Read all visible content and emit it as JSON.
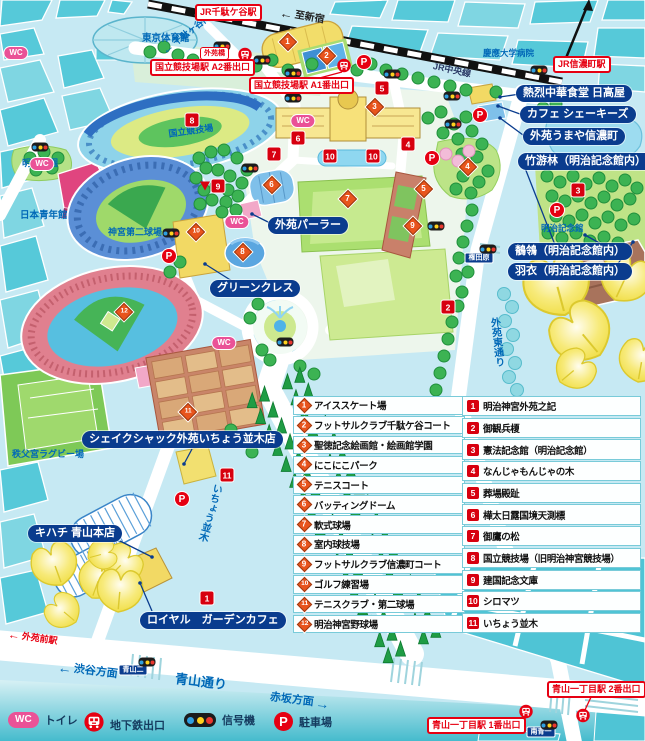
{
  "colors": {
    "navy": "#0a3c8e",
    "red": "#e60012",
    "marker_red": "#d7000f",
    "orange": "#e8541d",
    "pink": "#ea5297",
    "blue_text": "#0068b7",
    "signal_blue": "#2f9fe0",
    "signal_yellow": "#ffd21e",
    "signal_red": "#e8382f"
  },
  "map": {
    "wc_label": "WC",
    "parking_label": "P",
    "station_labels": [
      {
        "text": "JR千駄ケ谷駅",
        "x": 195,
        "y": 4
      },
      {
        "text": "国立競技場駅 A2番出口",
        "x": 150,
        "y": 59
      },
      {
        "text": "国立競技場駅 A1番出口",
        "x": 249,
        "y": 77
      },
      {
        "text": "JR信濃町駅",
        "x": 553,
        "y": 56
      },
      {
        "text": "青山一丁目駅 2番出口",
        "x": 547,
        "y": 681
      },
      {
        "text": "青山一丁目駅 1番出口",
        "x": 427,
        "y": 717
      }
    ],
    "small_red_labels": [
      {
        "text": "外苑橋",
        "x": 200,
        "y": 47
      }
    ],
    "pill_labels": [
      {
        "text": "熱烈中華食堂 日高屋",
        "x": 516,
        "y": 85
      },
      {
        "text": "カフェ シェーキーズ",
        "x": 520,
        "y": 106
      },
      {
        "text": "外苑うまや信濃町",
        "x": 523,
        "y": 128
      },
      {
        "text": "竹游林（明治記念館内）",
        "x": 518,
        "y": 153
      },
      {
        "text": "鶺鴒（明治記念館内）",
        "x": 508,
        "y": 243
      },
      {
        "text": "羽衣（明治記念館内）",
        "x": 508,
        "y": 263
      },
      {
        "text": "外苑パーラー",
        "x": 268,
        "y": 217
      },
      {
        "text": "グリーンクレス",
        "x": 210,
        "y": 280
      },
      {
        "text": "シェイクシャック外苑いちょう並木店",
        "x": 82,
        "y": 431
      },
      {
        "text": "キハチ 青山本店",
        "x": 28,
        "y": 525
      },
      {
        "text": "ロイヤル　ガーデンカフェ",
        "x": 140,
        "y": 612
      }
    ],
    "area_labels": [
      {
        "text": "東京体育館",
        "x": 142,
        "y": 34,
        "size": 9.5
      },
      {
        "text": "慶應大学病院",
        "x": 483,
        "y": 49,
        "size": 8.5
      },
      {
        "text": "JR中央線",
        "x": 434,
        "y": 62,
        "size": 9,
        "rot": 12,
        "color": "#2b3a66"
      },
      {
        "text": "明治公園",
        "x": 22,
        "y": 159,
        "size": 9
      },
      {
        "text": "日本青年館",
        "x": 20,
        "y": 211,
        "size": 9.5
      },
      {
        "text": "神宮第二球場",
        "x": 108,
        "y": 228,
        "size": 9
      },
      {
        "text": "国立競技場",
        "x": 168,
        "y": 130,
        "size": 9,
        "rot": -8
      },
      {
        "text": "明治記念館",
        "x": 541,
        "y": 224,
        "size": 8.5
      },
      {
        "text": "秩父宮ラグビー場",
        "x": 12,
        "y": 450,
        "size": 9
      },
      {
        "text": "青山通り",
        "x": 176,
        "y": 672,
        "size": 13,
        "rot": 7
      },
      {
        "text": "いちょう並木",
        "x": 212,
        "y": 482,
        "size": 10,
        "vert": true,
        "rot": 16
      },
      {
        "text": "外苑東通り",
        "x": 488,
        "y": 318,
        "size": 10,
        "vert": true,
        "rot": -6
      }
    ],
    "direction_labels": [
      {
        "text": "渋谷方面",
        "x": 58,
        "y": 660,
        "size": 11,
        "color": "#0068b7",
        "arrow": "left",
        "rot": 7
      },
      {
        "text": "赤坂方面",
        "x": 270,
        "y": 690,
        "size": 11,
        "color": "#0068b7",
        "arrow": "right",
        "rot": 7
      },
      {
        "text": "至新宿",
        "x": 280,
        "y": 6,
        "size": 10,
        "color": "#222222",
        "arrow": "left",
        "rot": 10
      },
      {
        "text": "外苑前駅",
        "x": 8,
        "y": 628,
        "size": 9,
        "color": "#e60012",
        "arrow": "left",
        "rot": 8
      },
      {
        "text": "千駄ヶ谷門",
        "x": 163,
        "y": 46,
        "size": 9,
        "color": "#0068b7",
        "arrow": "left",
        "rot": -38
      }
    ],
    "signs": [
      {
        "text": "権田原",
        "x": 479,
        "y": 258
      },
      {
        "text": "青山二",
        "x": 133,
        "y": 670
      },
      {
        "text": "南青一",
        "x": 541,
        "y": 732
      }
    ],
    "markers_orange": [
      {
        "n": "1",
        "x": 288,
        "y": 42
      },
      {
        "n": "2",
        "x": 327,
        "y": 56
      },
      {
        "n": "3",
        "x": 375,
        "y": 107
      },
      {
        "n": "4",
        "x": 468,
        "y": 167
      },
      {
        "n": "5",
        "x": 424,
        "y": 189
      },
      {
        "n": "6",
        "x": 272,
        "y": 185
      },
      {
        "n": "7",
        "x": 348,
        "y": 199
      },
      {
        "n": "8",
        "x": 243,
        "y": 252
      },
      {
        "n": "9",
        "x": 413,
        "y": 226
      },
      {
        "n": "10",
        "x": 196,
        "y": 232
      },
      {
        "n": "11",
        "x": 188,
        "y": 412
      },
      {
        "n": "12",
        "x": 124,
        "y": 312
      }
    ],
    "markers_red": [
      {
        "n": "1",
        "x": 207,
        "y": 598
      },
      {
        "n": "2",
        "x": 448,
        "y": 307
      },
      {
        "n": "3",
        "x": 578,
        "y": 190
      },
      {
        "n": "4",
        "x": 408,
        "y": 144
      },
      {
        "n": "5",
        "x": 382,
        "y": 88
      },
      {
        "n": "6",
        "x": 298,
        "y": 138
      },
      {
        "n": "7",
        "x": 274,
        "y": 154
      },
      {
        "n": "8",
        "x": 192,
        "y": 120
      },
      {
        "n": "9",
        "x": 218,
        "y": 186,
        "tri": true
      },
      {
        "n": "10",
        "x": 330,
        "y": 156
      },
      {
        "n": "10",
        "x": 373,
        "y": 156
      },
      {
        "n": "11",
        "x": 227,
        "y": 475
      }
    ],
    "wc": [
      {
        "x": 16,
        "y": 53
      },
      {
        "x": 42,
        "y": 164
      },
      {
        "x": 303,
        "y": 121
      },
      {
        "x": 237,
        "y": 222
      },
      {
        "x": 224,
        "y": 343
      }
    ],
    "parking": [
      {
        "x": 364,
        "y": 62
      },
      {
        "x": 480,
        "y": 115
      },
      {
        "x": 432,
        "y": 158
      },
      {
        "x": 557,
        "y": 210
      },
      {
        "x": 169,
        "y": 256
      },
      {
        "x": 182,
        "y": 499
      }
    ],
    "subway": [
      {
        "x": 245,
        "y": 57
      },
      {
        "x": 344,
        "y": 68
      },
      {
        "x": 526,
        "y": 714
      },
      {
        "x": 583,
        "y": 718
      }
    ],
    "signals": [
      {
        "x": 222,
        "y": 46
      },
      {
        "x": 262,
        "y": 60
      },
      {
        "x": 293,
        "y": 73
      },
      {
        "x": 392,
        "y": 74
      },
      {
        "x": 293,
        "y": 98
      },
      {
        "x": 539,
        "y": 70
      },
      {
        "x": 452,
        "y": 96
      },
      {
        "x": 453,
        "y": 124
      },
      {
        "x": 250,
        "y": 168
      },
      {
        "x": 40,
        "y": 147
      },
      {
        "x": 171,
        "y": 233
      },
      {
        "x": 436,
        "y": 226
      },
      {
        "x": 488,
        "y": 249
      },
      {
        "x": 285,
        "y": 342
      },
      {
        "x": 147,
        "y": 662
      },
      {
        "x": 549,
        "y": 725
      }
    ]
  },
  "legend": {
    "facilities": [
      {
        "n": "1",
        "label": "アイススケート場"
      },
      {
        "n": "2",
        "label": "フットサルクラブ千駄ケ谷コート"
      },
      {
        "n": "3",
        "label": "聖徳記念絵画館・絵画館学園"
      },
      {
        "n": "4",
        "label": "にこにこパーク"
      },
      {
        "n": "5",
        "label": "テニスコート"
      },
      {
        "n": "6",
        "label": "バッティングドーム"
      },
      {
        "n": "7",
        "label": "軟式球場"
      },
      {
        "n": "8",
        "label": "室内球技場"
      },
      {
        "n": "9",
        "label": "フットサルクラブ信濃町コート"
      },
      {
        "n": "10",
        "label": "ゴルフ練習場"
      },
      {
        "n": "11",
        "label": "テニスクラブ・第二球場"
      },
      {
        "n": "12",
        "label": "明治神宮野球場"
      }
    ],
    "monuments": [
      {
        "n": "1",
        "label": "明治神宮外苑之記"
      },
      {
        "n": "2",
        "label": "御観兵榎"
      },
      {
        "n": "3",
        "label": "憲法記念館（明治記念館）"
      },
      {
        "n": "4",
        "label": "なんじゃもんじゃの木"
      },
      {
        "n": "5",
        "label": "葬場殿趾"
      },
      {
        "n": "6",
        "label": "樺太日露国境天測標"
      },
      {
        "n": "7",
        "label": "御鷹の松"
      },
      {
        "n": "8",
        "label": "国立競技場（旧明治神宮競技場）"
      },
      {
        "n": "9",
        "label": "建国記念文庫"
      },
      {
        "n": "10",
        "label": "シロマツ"
      },
      {
        "n": "11",
        "label": "いちょう並木"
      }
    ]
  },
  "footer": {
    "wc_text": "WC",
    "parking_text": "P",
    "items": [
      {
        "icon": "wc-icon",
        "label": "トイレ"
      },
      {
        "icon": "subway-icon",
        "label": "地下鉄出口"
      },
      {
        "icon": "signal-icon",
        "label": "信号機"
      },
      {
        "icon": "parking-icon",
        "label": "駐車場"
      }
    ]
  }
}
